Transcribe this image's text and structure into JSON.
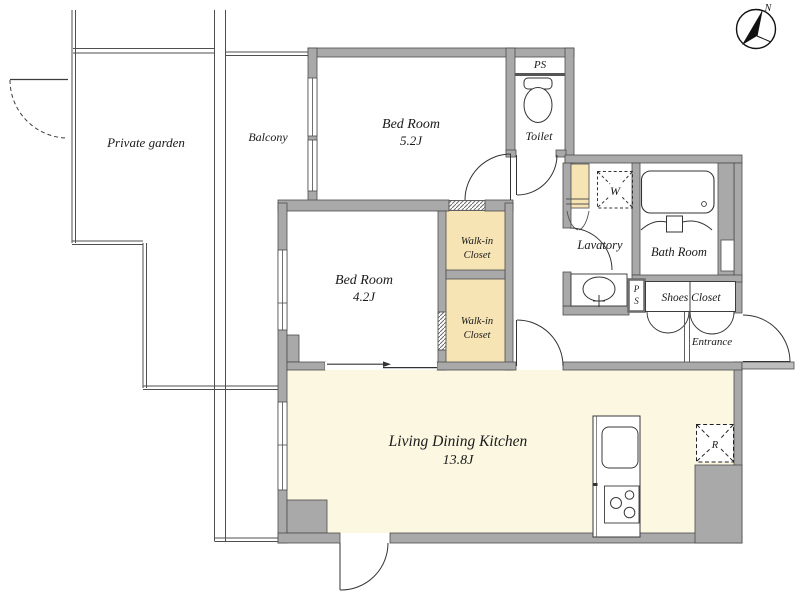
{
  "colors": {
    "wall": "#a9a9a9",
    "wall_outline": "#4c4c4c",
    "ldk_floor": "#fbf7e1",
    "closet_floor": "#f6e4b4",
    "line": "#3c3c3c"
  },
  "compass": {
    "north": "N"
  },
  "outdoor": {
    "private_garden": "Private garden",
    "balcony": "Balcony"
  },
  "rooms": {
    "bedroom_upper": {
      "name": "Bed Room",
      "area": "5.2J"
    },
    "bedroom_lower": {
      "name": "Bed Room",
      "area": "4.2J"
    },
    "ldk": {
      "name": "Living Dining Kitchen",
      "area": "13.8J"
    },
    "toilet": {
      "name": "Toilet"
    },
    "lavatory": {
      "name": "Lavatory"
    },
    "bath": {
      "name": "Bath Room"
    },
    "walkin_upper": {
      "line1": "Walk-in",
      "line2": "Closet"
    },
    "walkin_lower": {
      "line1": "Walk-in",
      "line2": "Closet"
    },
    "shoes_closet": {
      "name": "Shoes Closet"
    },
    "entrance": {
      "name": "Entrance"
    }
  },
  "labels": {
    "ps_top": "PS",
    "ps_side_p": "P",
    "ps_side_s": "S",
    "washer": "W",
    "fridge": "R"
  }
}
